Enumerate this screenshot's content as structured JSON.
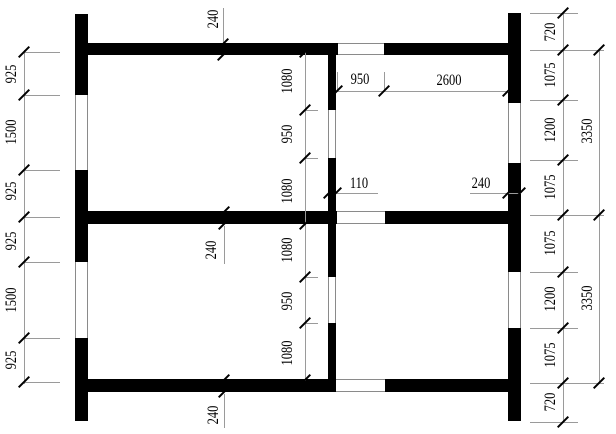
{
  "drawing": {
    "type": "architectural floor plan",
    "units": "mm"
  },
  "colors": {
    "wall": "#000000",
    "thin_line": "#9a9a9a",
    "text": "#000000",
    "background": "#ffffff"
  },
  "dims": {
    "left_chain": [
      "925",
      "1500",
      "925",
      "925",
      "1500",
      "925"
    ],
    "center_chain": [
      "1080",
      "950",
      "1080",
      "1080",
      "950",
      "1080"
    ],
    "right_inner_chain": [
      "720",
      "1075",
      "1200",
      "1075",
      "1075",
      "1200",
      "1075",
      "720"
    ],
    "right_outer_chain": [
      "3350",
      "3350"
    ],
    "top_width_chain": [
      "950",
      "2600"
    ],
    "thickness": {
      "partition": "110",
      "right_wall": "240",
      "top_wall": "240",
      "middle_wall": "240",
      "bottom_wall": "240"
    }
  }
}
